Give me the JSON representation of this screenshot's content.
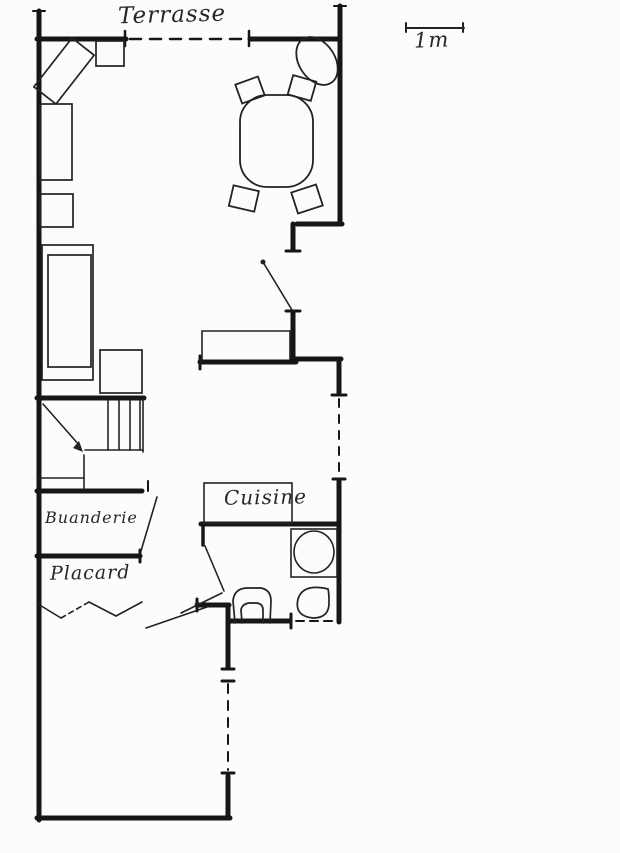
{
  "labels": {
    "terrasse": "Terrasse",
    "cuisine": "Cuisine",
    "buanderie": "Buanderie",
    "placard": "Placard"
  },
  "scale_bar": {
    "label": "1m"
  },
  "colors": {
    "ink": "#1f1f1f",
    "wall": "#161616",
    "paper": "#fcfcfa"
  }
}
